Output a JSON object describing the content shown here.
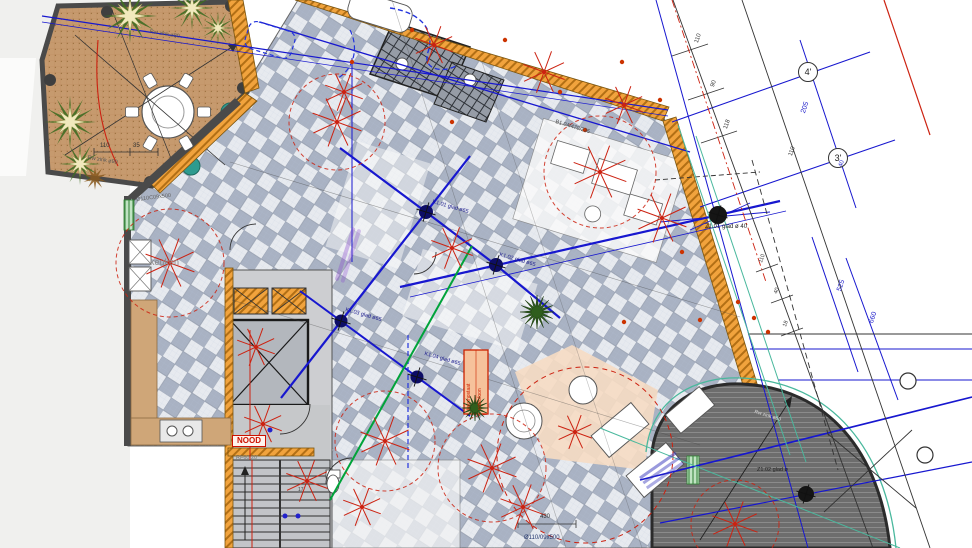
{
  "plan": {
    "rooms": {
      "kitchen": "keuken"
    },
    "safety": {
      "emergency_exit": "NOOD",
      "fire_rating": "RF60 20'"
    },
    "annotations": {
      "rw_top": "Rw zink ø80",
      "rw_left": "Rw zink ø90",
      "rw_balcony": "Rw zink ø80",
      "duct": "Ø110C09x500",
      "beam_ref": "B1.04/470/235",
      "bottom_ref": "Ø110/09x500",
      "device_line1": "thermostaat",
      "device_line2": "videofoon",
      "stair_count": "17"
    },
    "columns": {
      "k101": "K1.01 glad ø65",
      "k102": "K1.02 glad ø65",
      "k103": "K1.03 glad ø65",
      "k104": "K1.04 glad ø65",
      "z101": "Z1.01 glad ø 40",
      "z102": "Z1.02 glad ø"
    },
    "grid_bubbles": {
      "b4": "4'",
      "b3": "3'"
    },
    "dimensions": {
      "d205": "205",
      "d40": "40",
      "d525": "525",
      "d660": "660",
      "d110a": "110",
      "d90": "90",
      "d118": "118",
      "d110b": "110",
      "d110c": "110",
      "d40b": "40",
      "d18": "18",
      "t110": "110",
      "t35": "35",
      "d430": "430"
    },
    "colors": {
      "beam_blue": "#1717cf",
      "sprinkler_red": "#cc2211",
      "wall_orange": "#f1a33d",
      "tile_gray": "#a9b2c3",
      "terrace_tan": "#c69a6e",
      "accent_green": "#00a33a",
      "teal": "#49b89d"
    }
  }
}
